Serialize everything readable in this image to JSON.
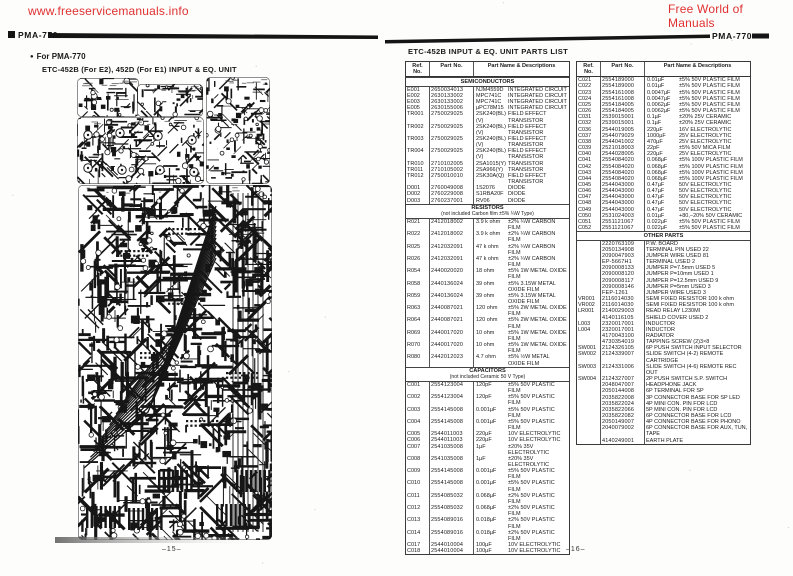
{
  "header": {
    "left_site": "www.freeservicemanuals.info",
    "right_site": "Free World of Manuals",
    "accent_red": "#e03131",
    "model_left": "PMA-770",
    "model_right": "PMA-770"
  },
  "left_page": {
    "bullet": "●",
    "for_label": "For PMA-770",
    "unit_title": "ETC-452B (For E2), 452D (For E1)  INPUT & EQ. UNIT",
    "page_number": "–15–"
  },
  "right_page": {
    "title": "ETC-452B INPUT & EQ. UNIT PARTS LIST",
    "page_number": "–16–",
    "table": {
      "columns": [
        "Ref.\nNo.",
        "Part No.",
        "Part Name & Descriptions"
      ],
      "left_sections": [
        {
          "title": "SEMICONDUCTORS",
          "note": "",
          "rows": [
            [
              "E001",
              "2650034013",
              "NJM4559D",
              "INTEGRATED CIRCUIT"
            ],
            [
              "E002",
              "2630133002",
              "MPC741C",
              "INTEGRATED CIRCUIT"
            ],
            [
              "E003",
              "2630133002",
              "MPC741C",
              "INTEGRATED CIRCUIT"
            ],
            [
              "E005",
              "2630155006",
              "µPC78M15",
              "INTEGRATED CIRCUIT"
            ],
            [
              "TR001",
              "2750029025",
              "2SK240(BL)(V)",
              "FIELD EFFECT TRANSISTOR"
            ],
            [
              "TR002",
              "2750029025",
              "2SK240(BL)(V)",
              "FIELD EFFECT TRANSISTOR"
            ],
            [
              "TR003",
              "2750029025",
              "2SK240(BL)(V)",
              "FIELD EFFECT TRANSISTOR"
            ],
            [
              "TR004",
              "2750029025",
              "2SK240(BL)(V)",
              "FIELD EFFECT TRANSISTOR"
            ],
            [
              "TR010",
              "2710102005",
              "2SA1015(Y)",
              "TRANSISTOR"
            ],
            [
              "TR011",
              "2710105002",
              "2SA966(Y)",
              "TRANSISTOR"
            ],
            [
              "TR012",
              "2750010010",
              "2SK30A(Q)",
              "FIELD EFFECT TRANSISTOR"
            ],
            [
              "D001",
              "2760049008",
              "1S2076",
              "DIODE"
            ],
            [
              "D002",
              "2760229008",
              "S1RBA20F",
              "DIODE"
            ],
            [
              "D003",
              "2760237001",
              "RV06",
              "DIODE"
            ]
          ]
        },
        {
          "title": "RESISTORS",
          "note": "(not included Carbon film ±5% ¼W Type)",
          "rows": [
            [
              "R021",
              "2412018002",
              "3.9 k ohm",
              "±2% ¼W  CARBON FILM"
            ],
            [
              "R022",
              "2412018002",
              "3.9 k ohm",
              "±2% ¼W  CARBON FILM"
            ],
            [
              "R025",
              "2412032091",
              "47 k ohm",
              "±2% ¼W  CARBON FILM"
            ],
            [
              "R026",
              "2412032091",
              "47 k ohm",
              "±2% ¼W  CARBON FILM"
            ],
            [
              "R054",
              "2440020020",
              "18 ohm",
              "±5% 1W  METAL OXIDE FILM"
            ],
            [
              "R058",
              "2440136024",
              "39 ohm",
              "±5% 3.15W  METAL OXIDE FILM"
            ],
            [
              "R059",
              "2440136024",
              "39 ohm",
              "±5% 3.15W  METAL OXIDE FILM"
            ],
            [
              "R063",
              "2440087021",
              "120 ohm",
              "±5% 2W  METAL OXIDE FILM"
            ],
            [
              "R064",
              "2440087021",
              "120 ohm",
              "±5% 2W  METAL OXIDE FILM"
            ],
            [
              "R069",
              "2440017020",
              "10 ohm",
              "±5% 1W  METAL OXIDE FILM"
            ],
            [
              "R070",
              "2440017020",
              "10 ohm",
              "±5% 1W  METAL OXIDE FILM"
            ],
            [
              "R080",
              "2442012023",
              "4.7 ohm",
              "±5% ½W  METAL OXIDE FILM"
            ]
          ]
        },
        {
          "title": "CAPACITORS",
          "note": "(not included Ceramic 50 V Type)",
          "rows": [
            [
              "C001",
              "2554123004",
              "120pF",
              "±5% 50V PLASTIC FILM"
            ],
            [
              "C002",
              "2554123004",
              "120pF",
              "±5% 50V PLASTIC FILM"
            ],
            [
              "C003",
              "2554145008",
              "0.001µF",
              "±5% 50V PLASTIC FILM"
            ],
            [
              "C004",
              "2554145008",
              "0.001µF",
              "±5% 50V PLASTIC FILM"
            ],
            [
              "C005",
              "2544011003",
              "220µF",
              "10V ELECTROLYTIC"
            ],
            [
              "C006",
              "2544011003",
              "220µF",
              "10V ELECTROLYTIC"
            ],
            [
              "C007",
              "2541035008",
              "1µF",
              "±20% 35V ELECTROLYTIC"
            ],
            [
              "C008",
              "2541035008",
              "1µF",
              "±20% 35V ELECTROLYTIC"
            ],
            [
              "C009",
              "2554145008",
              "0.001µF",
              "±5% 50V PLASTIC FILM"
            ],
            [
              "C010",
              "2554145008",
              "0.001µF",
              "±5% 50V PLASTIC FILM"
            ],
            [
              "C011",
              "2554085032",
              "0.068µF",
              "±2% 50V PLASTIC FILM"
            ],
            [
              "C012",
              "2554085032",
              "0.068µF",
              "±2% 50V PLASTIC FILM"
            ],
            [
              "C013",
              "2554089016",
              "0.018µF",
              "±2% 50V PLASTIC FILM"
            ],
            [
              "C014",
              "2554089016",
              "0.018µF",
              "±2% 50V PLASTIC FILM"
            ],
            [
              "C017",
              "2544010004",
              "100µF",
              "10V ELECTROLYTIC"
            ],
            [
              "C018",
              "2544010004",
              "100µF",
              "10V ELECTROLYTIC"
            ]
          ]
        }
      ],
      "right_sections": [
        {
          "title": "",
          "note": "",
          "rows": [
            [
              "C021",
              "2554189000",
              "0.01µF",
              "±5% 50V PLASTIC FILM"
            ],
            [
              "C022",
              "2554189000",
              "0.01µF",
              "±5% 50V PLASTIC FILM"
            ],
            [
              "C023",
              "2554161008",
              "0.0047µF",
              "±5% 50V PLASTIC FILM"
            ],
            [
              "C024",
              "2554161008",
              "0.0047µF",
              "±5% 50V PLASTIC FILM"
            ],
            [
              "C025",
              "2554184005",
              "0.0062µF",
              "±5% 50V PLASTIC FILM"
            ],
            [
              "C026",
              "2554184005",
              "0.0062µF",
              "±5% 50V PLASTIC FILM"
            ],
            [
              "C031",
              "2539015001",
              "0.1µF",
              "±20% 25V CERAMIC"
            ],
            [
              "C032",
              "2539015001",
              "0.1µF",
              "±20% 25V CERAMIC"
            ],
            [
              "C036",
              "2544019005",
              "220µF",
              "16V ELECTROLYTIC"
            ],
            [
              "C037",
              "2544079029",
              "1000µF",
              "25V ELECTROLYTIC"
            ],
            [
              "C038",
              "2544041002",
              "470µF",
              "25V ELECTROLYTIC"
            ],
            [
              "C039",
              "2521018003",
              "22pF",
              "±5% 50V MICA FILM"
            ],
            [
              "C040",
              "2544028005",
              "220µF",
              "25V ELECTROLYTIC"
            ],
            [
              "C041",
              "2554084020",
              "0.068µF",
              "±5% 100V  PLASTIC FILM"
            ],
            [
              "C042",
              "2554084020",
              "0.068µF",
              "±5% 100V  PLASTIC FILM"
            ],
            [
              "C043",
              "2554084020",
              "0.068µF",
              "±5% 100V  PLASTIC FILM"
            ],
            [
              "C044",
              "2554084020",
              "0.068µF",
              "±5% 100V  PLASTIC FILM"
            ],
            [
              "C045",
              "2544043000",
              "0.47µF",
              "50V ELECTROLYTIC"
            ],
            [
              "C046",
              "2544043000",
              "0.47µF",
              "50V ELECTROLYTIC"
            ],
            [
              "C047",
              "2544043000",
              "0.47µF",
              "50V ELECTROLYTIC"
            ],
            [
              "C048",
              "2544043000",
              "0.47µF",
              "50V ELECTROLYTIC"
            ],
            [
              "C049",
              "2544043000",
              "0.47µF",
              "50V ELECTROLYTIC"
            ],
            [
              "C050",
              "2531024003",
              "0.01µF",
              "+80,−20%  50V CERAMIC"
            ],
            [
              "C051",
              "2551121067",
              "0.022µF",
              "±5% 50V PLASTIC FILM"
            ],
            [
              "C052",
              "2551121067",
              "0.022µF",
              "±5% 50V PLASTIC FILM"
            ]
          ]
        },
        {
          "title": "OTHER PARTS",
          "note": "",
          "rows": [
            [
              "",
              "2220763109",
              "P.W. BOARD",
              ""
            ],
            [
              "",
              "2050134908",
              "TERMINAL PIN  USED 22",
              ""
            ],
            [
              "",
              "2090047903",
              "JUMPER WIRE  USED 81",
              ""
            ],
            [
              "",
              "EP-5667H1",
              "TERMINAL  USED 2",
              ""
            ],
            [
              "",
              "2090008133",
              "JUMPER P=7.5mm USED 5",
              ""
            ],
            [
              "",
              "2090008120",
              "JUMPER P=10mm USED 1",
              ""
            ],
            [
              "",
              "2090008117",
              "JUMPER P=12.5mm USED 9",
              ""
            ],
            [
              "",
              "2090008146",
              "JUMPER P=5mm USED 3",
              ""
            ],
            [
              "",
              "FEP-1261",
              "JUMPER WIRE USED 3",
              ""
            ],
            [
              "VR001",
              "2116014030",
              "SEMI FIXED RESISTOR 100 k ohm",
              ""
            ],
            [
              "VR002",
              "2116014030",
              "SEMI FIXED RESISTOR 100 k ohm",
              ""
            ],
            [
              "LR001",
              "2140029003",
              "READ RELAY L230MI",
              ""
            ],
            [
              "",
              "4140116105",
              "SHIELD COVER USED 2",
              ""
            ],
            [
              "L003",
              "2320017001",
              "INDUCTOR",
              ""
            ],
            [
              "L004",
              "2320017001",
              "INDUCTOR",
              ""
            ],
            [
              "",
              "4170043100",
              "RADIATOR",
              ""
            ],
            [
              "",
              "4730354019",
              "TAPPING SCREW (2)3×8",
              ""
            ],
            [
              "SW001",
              "2124326105",
              "6P PUSH SWITCH  INPUT SELECTOR",
              ""
            ],
            [
              "SW002",
              "2124339007",
              "SLIDE SWITCH (4-2) REMOTE  CARTRIDGE",
              ""
            ],
            [
              "SW003",
              "2124331006",
              "SLIDE SWITCH (4-6) REMOTE  REC OUT",
              ""
            ],
            [
              "SW004",
              "2124327007",
              "2P PUSH SWITCH  S.P. SWITCH",
              ""
            ],
            [
              "",
              "2048047007",
              "HEADPHONE JACK",
              ""
            ],
            [
              "",
              "2050144008",
              "6P TERMINAL FOR SP",
              ""
            ],
            [
              "",
              "2035822008",
              "3P CONNECTOR BASE FOR SP LED",
              ""
            ],
            [
              "",
              "2035822024",
              "4P MINI CON. PIN FOR LCD",
              ""
            ],
            [
              "",
              "2035822066",
              "5P MINI CON. PIN FOR LCD",
              ""
            ],
            [
              "",
              "2035822082",
              "6P CONNECTOR BASE FOR LCD",
              ""
            ],
            [
              "",
              "2050149007",
              "4P CONNECTOR BASE FOR PHONO",
              ""
            ],
            [
              "",
              "2040079002",
              "6P CONNECTOR BASE FOR AUX, TUN, TAPE",
              ""
            ],
            [
              "",
              "4140249001",
              "EARTH PLATE",
              ""
            ]
          ]
        }
      ]
    }
  }
}
